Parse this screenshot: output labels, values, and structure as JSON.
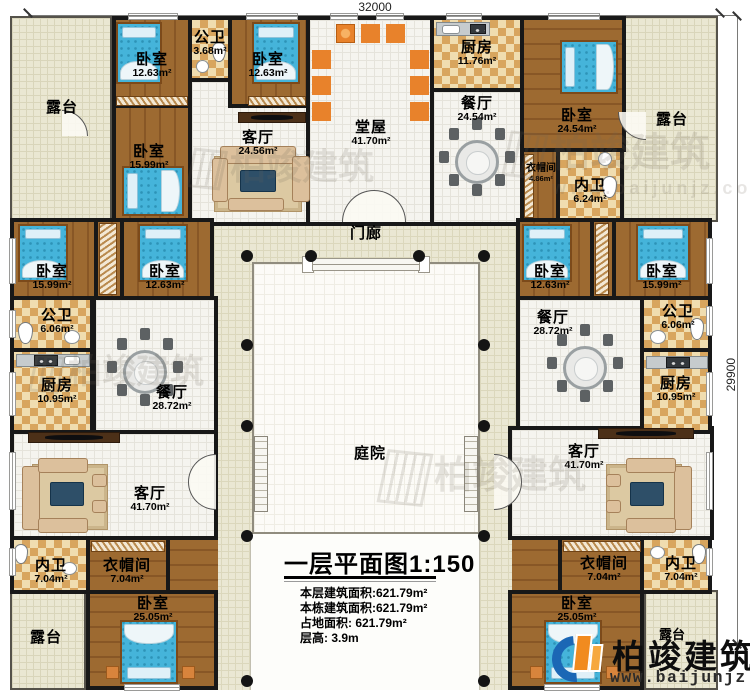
{
  "dimensions": {
    "top_width": "32000",
    "right_height": "29900"
  },
  "plan_title": {
    "text": "一层平面图",
    "scale": "1:150"
  },
  "stats": {
    "floor_area": "本层建筑面积:621.79m²",
    "building_area": "本栋建筑面积:621.79m²",
    "land_area": "占地面积: 621.79m²",
    "floor_height": "层高: 3.9m"
  },
  "branding": {
    "name": "柏竣建筑",
    "website": "www.baijunjz.com"
  },
  "watermark": {
    "name": "柏竣建筑",
    "website": "www.baijunjz.com"
  },
  "rooms": [
    {
      "name": "露台",
      "area": ""
    },
    {
      "name": "卧室",
      "area": "12.63m²"
    },
    {
      "name": "公卫",
      "area": "3.68m²"
    },
    {
      "name": "卧室",
      "area": "12.63m²"
    },
    {
      "name": "堂屋",
      "area": "41.70m²"
    },
    {
      "name": "厨房",
      "area": "11.76m²"
    },
    {
      "name": "餐厅",
      "area": "24.54m²"
    },
    {
      "name": "卧室",
      "area": "24.54m²"
    },
    {
      "name": "露台",
      "area": ""
    },
    {
      "name": "卧室",
      "area": "15.99m²"
    },
    {
      "name": "客厅",
      "area": "24.56m²"
    },
    {
      "name": "衣帽间",
      "area": "4.86m²"
    },
    {
      "name": "内卫",
      "area": "6.24m²"
    },
    {
      "name": "门廊",
      "area": ""
    },
    {
      "name": "卧室",
      "area": "15.99m²"
    },
    {
      "name": "卧室",
      "area": "12.63m²"
    },
    {
      "name": "公卫",
      "area": "6.06m²"
    },
    {
      "name": "厨房",
      "area": "10.95m²"
    },
    {
      "name": "餐厅",
      "area": "28.72m²"
    },
    {
      "name": "卧室",
      "area": "12.63m²"
    },
    {
      "name": "卧室",
      "area": "15.99m²"
    },
    {
      "name": "餐厅",
      "area": "28.72m²"
    },
    {
      "name": "公卫",
      "area": "6.06m²"
    },
    {
      "name": "厨房",
      "area": "10.95m²"
    },
    {
      "name": "庭院",
      "area": ""
    },
    {
      "name": "客厅",
      "area": "41.70m²"
    },
    {
      "name": "内卫",
      "area": "7.04m²"
    },
    {
      "name": "衣帽间",
      "area": "7.04m²"
    },
    {
      "name": "卧室",
      "area": "25.05m²"
    },
    {
      "name": "露台",
      "area": ""
    },
    {
      "name": "客厅",
      "area": "41.70m²"
    },
    {
      "name": "衣帽间",
      "area": "7.04m²"
    },
    {
      "name": "内卫",
      "area": "7.04m²"
    },
    {
      "name": "卧室",
      "area": "25.05m²"
    },
    {
      "name": "露台",
      "area": ""
    }
  ]
}
